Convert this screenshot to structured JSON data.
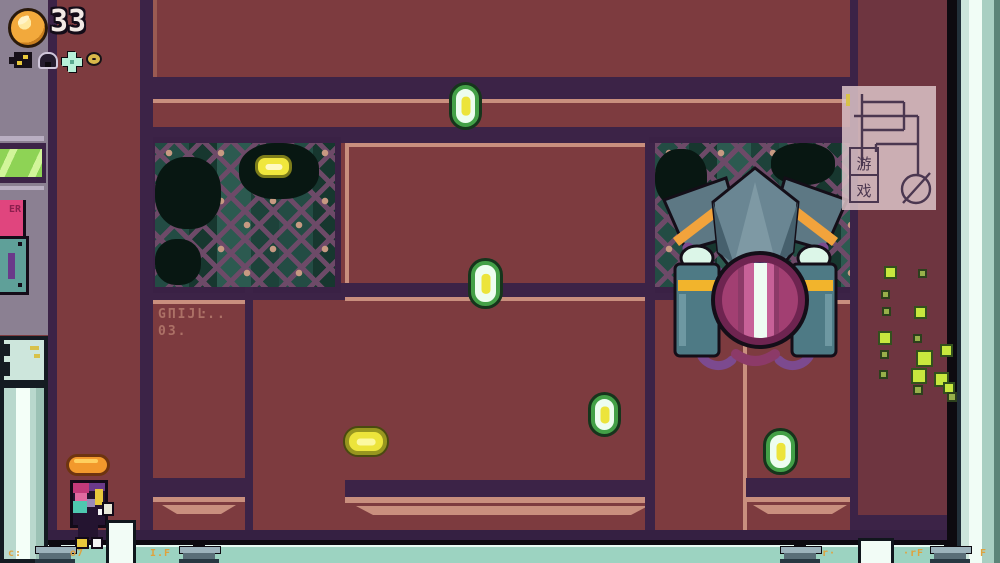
{
  "hud": {
    "coin_count": "33",
    "icons": [
      {
        "name": "blaster-icon"
      },
      {
        "name": "helmet-icon"
      },
      {
        "name": "flower-icon"
      },
      {
        "name": "ring-icon"
      }
    ]
  },
  "watermark": {
    "char1": "游",
    "char2": "戏"
  },
  "wall": {
    "stencil_line1": "GΠIJĿ..",
    "stencil_line2": "03.",
    "sign_text": "ER"
  },
  "coins": [
    {
      "type": "vertical",
      "x": 452,
      "y": 85,
      "w": 27,
      "h": 42
    },
    {
      "type": "window",
      "x": 255,
      "y": 155,
      "w": 37,
      "h": 23
    },
    {
      "type": "vertical",
      "x": 471,
      "y": 261,
      "w": 29,
      "h": 45
    },
    {
      "type": "vertical",
      "x": 591,
      "y": 395,
      "w": 27,
      "h": 39
    },
    {
      "type": "pill",
      "x": 345,
      "y": 428,
      "w": 42,
      "h": 27
    },
    {
      "type": "vertical",
      "x": 766,
      "y": 431,
      "w": 29,
      "h": 41
    }
  ],
  "particles": [
    {
      "x": 884,
      "y": 266,
      "s": 9
    },
    {
      "x": 881,
      "y": 290,
      "s": 5,
      "dim": true
    },
    {
      "x": 882,
      "y": 307,
      "s": 5,
      "dim": true
    },
    {
      "x": 878,
      "y": 331,
      "s": 10
    },
    {
      "x": 880,
      "y": 350,
      "s": 5,
      "dim": true
    },
    {
      "x": 879,
      "y": 370,
      "s": 5,
      "dim": true
    },
    {
      "x": 918,
      "y": 269,
      "s": 5,
      "dim": true
    },
    {
      "x": 914,
      "y": 306,
      "s": 9
    },
    {
      "x": 913,
      "y": 334,
      "s": 5,
      "dim": true
    },
    {
      "x": 916,
      "y": 350,
      "s": 13
    },
    {
      "x": 940,
      "y": 344,
      "s": 9
    },
    {
      "x": 911,
      "y": 368,
      "s": 12
    },
    {
      "x": 934,
      "y": 372,
      "s": 11
    },
    {
      "x": 913,
      "y": 385,
      "s": 6,
      "dim": true
    },
    {
      "x": 943,
      "y": 382,
      "s": 8
    },
    {
      "x": 947,
      "y": 392,
      "s": 6,
      "dim": true
    }
  ],
  "floor": {
    "pedestals": [
      55,
      199,
      800,
      950
    ],
    "posts": [
      {
        "x": 106,
        "y": 520,
        "w": 24,
        "h": 43
      },
      {
        "x": 858,
        "y": 538,
        "w": 30,
        "h": 25
      }
    ],
    "glyphs": [
      {
        "x": 8,
        "t": "c:"
      },
      {
        "x": 70,
        "t": "o7"
      },
      {
        "x": 150,
        "t": "I.F"
      },
      {
        "x": 822,
        "t": "r·"
      },
      {
        "x": 903,
        "t": "·rF"
      },
      {
        "x": 980,
        "t": "F"
      }
    ]
  },
  "colors": {
    "wall": "#7d3b3f",
    "wall_dark": "#6e3540",
    "band_purple": "#3c2347",
    "trim_salmon": "#c98f7e",
    "floor_teal": "#9cd3c1",
    "coin_yellow": "#ece43b",
    "coin_green": "#43a047",
    "boss_magenta": "#a23f72",
    "tank_teal": "#4e7a85",
    "particle_green": "#c8e83e",
    "hud_gold": "#f2a93c"
  }
}
